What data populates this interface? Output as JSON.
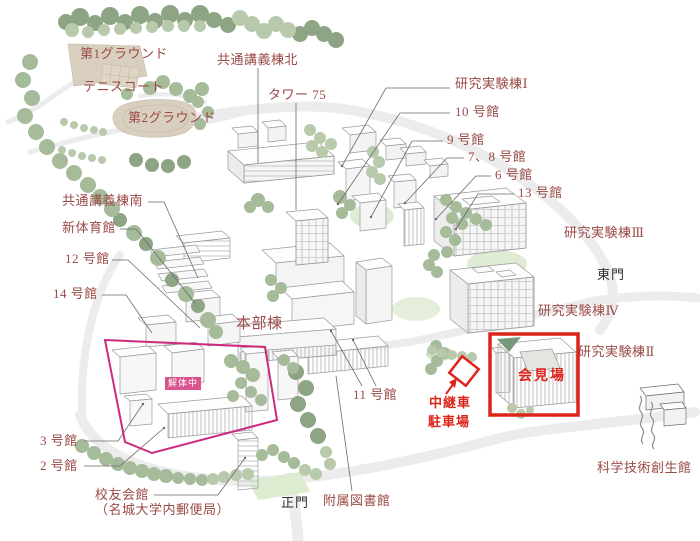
{
  "labels": {
    "ground_1": "第1グラウンド",
    "tennis_court": "テニスコート",
    "ground_2": "第2グラウンド",
    "common_lecture_north": "共通講義棟北",
    "tower_75": "タワー 75",
    "research_lab_1": "研究実験棟Ⅰ",
    "bldg_10": "10 号館",
    "bldg_9": "9 号館",
    "bldg_7_8": "7、8 号館",
    "bldg_6": "6 号館",
    "bldg_13": "13 号館",
    "research_lab_3": "研究実験棟Ⅲ",
    "east_gate": "東門",
    "research_lab_4": "研究実験棟Ⅳ",
    "research_lab_2": "研究実験棟Ⅱ",
    "common_lecture_south": "共通講義棟南",
    "new_gym": "新体育館",
    "bldg_12": "12 号館",
    "bldg_14": "14 号館",
    "headquarters": "本部棟",
    "bldg_11": "11 号館",
    "relay_van_line1": "中継車",
    "relay_van_line2": "駐車場",
    "press_venue": "会見場",
    "bldg_3": "3 号館",
    "bldg_2": "2 号館",
    "alumni_hall": "校友会館",
    "alumni_hall_sub": "（名城大学内郵便局）",
    "main_gate": "正門",
    "library": "附属図書館",
    "science_tech_hall": "科学技術創生館",
    "demolition": "解体中"
  },
  "colors": {
    "label_maroon": "#9a4a46",
    "black_label": "#332f2e",
    "highlight_red": "#dc241a",
    "demolition_pink": "#cc2b7d",
    "badge_pink": "#d9538c",
    "tree_green": "#a6bb9a",
    "road_gray": "#ebebeb",
    "ground_beige": "#d8cfbf"
  }
}
